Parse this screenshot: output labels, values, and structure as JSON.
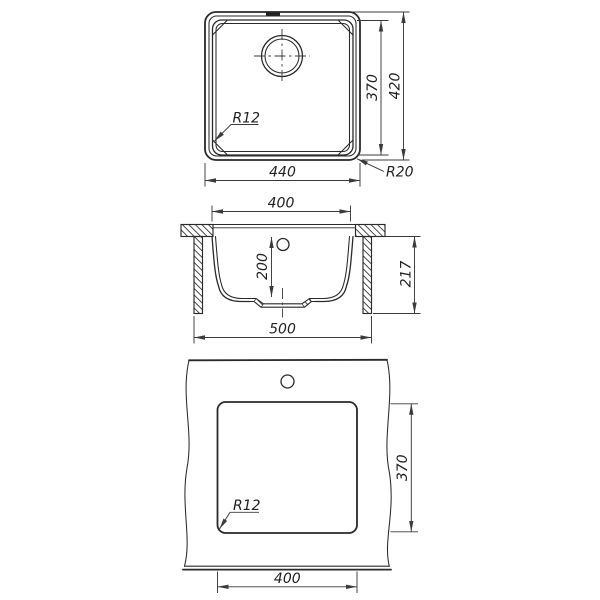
{
  "drawing": {
    "colors": {
      "line": "#2a2a2a",
      "dimension_line": "#3b3b3b",
      "background": "#ffffff"
    },
    "views": {
      "top": {
        "width": "440",
        "bowl_height": "370",
        "overall_height": "420",
        "bowl_corner_radius": "R12",
        "outer_corner_radius": "R20"
      },
      "section": {
        "opening_width": "400",
        "bowl_depth": "200",
        "overall_width": "500",
        "overall_height": "217"
      },
      "cutout": {
        "cutout_width": "400",
        "cutout_height": "370",
        "corner_radius": "R12"
      }
    }
  }
}
